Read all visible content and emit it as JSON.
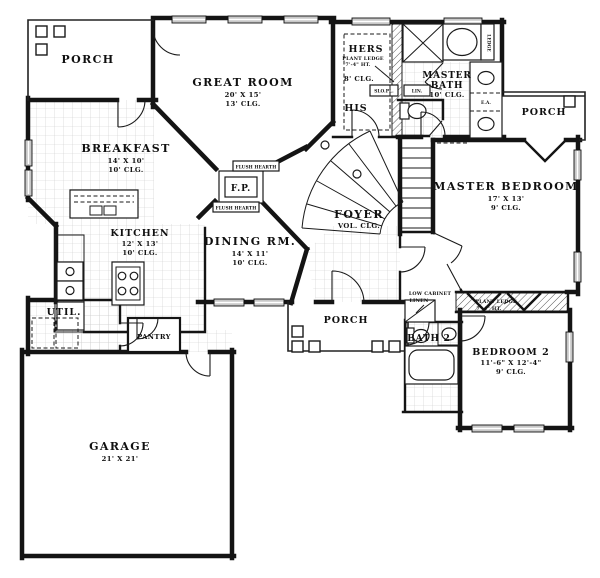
{
  "plan": {
    "rooms": {
      "porch_top_left": {
        "name": "PORCH"
      },
      "great_room": {
        "name": "GREAT ROOM",
        "dim": "20' X 15'",
        "ceiling": "13' CLG."
      },
      "hers_closet": {
        "name": "HERS",
        "ledge_note_1": "PLANT LEDGE",
        "ledge_note_2": "7'-4\" HT.",
        "ceiling": "8' CLG."
      },
      "his_closet": {
        "name": "HIS"
      },
      "master_bath": {
        "name_1": "MASTER",
        "name_2": "BATH",
        "ceiling": "10' CLG."
      },
      "porch_right": {
        "name": "PORCH"
      },
      "master_bedroom": {
        "name": "MASTER BEDROOM",
        "dim": "17' X 13'",
        "ceiling": "9' CLG."
      },
      "breakfast": {
        "name": "BREAKFAST",
        "dim": "14' X 10'",
        "ceiling": "10' CLG."
      },
      "kitchen": {
        "name": "KITCHEN",
        "dim": "12' X 13'",
        "ceiling": "10' CLG."
      },
      "dining_room": {
        "name": "DINING RM.",
        "dim": "14' X 11'",
        "ceiling": "10' CLG."
      },
      "foyer": {
        "name": "FOYER",
        "ceiling": "VOL. CLG."
      },
      "utility": {
        "name": "UTIL."
      },
      "pantry": {
        "name": "PANTRY"
      },
      "porch_bottom": {
        "name": "PORCH"
      },
      "bath_2": {
        "name": "BATH 2"
      },
      "bedroom_2": {
        "name": "BEDROOM 2",
        "dim": "11'-6\" X 12'-4\"",
        "ceiling": "9' CLG.",
        "ledge_note_1": "PLANT LEDGE",
        "ledge_note_2": "7'-4\" HT."
      },
      "garage": {
        "name": "GARAGE",
        "dim": "21' X 21'"
      }
    },
    "annotations": {
      "fireplace": "F.P.",
      "flush_hearth_top": "FLUSH HEARTH",
      "flush_hearth_bottom": "FLUSH HEARTH",
      "low_cabinet_1": "LOW CABINET",
      "low_cabinet_2": "LINEN",
      "slope_plate": "SLO.PL.",
      "linen": "LIN.",
      "ledge": "LEDGE",
      "each": "E.A."
    },
    "colors": {
      "ink": "#141414",
      "tile_grid": "#c9c9c9",
      "window_fill": "#c8c8c8"
    }
  }
}
